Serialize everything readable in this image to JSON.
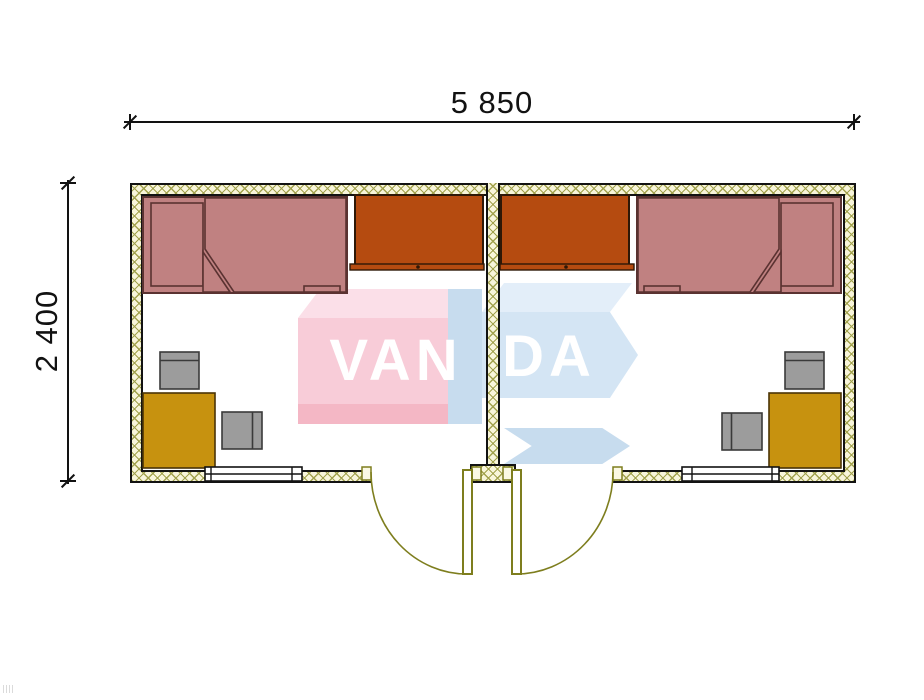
{
  "dimensions": {
    "width_label": "5 850",
    "height_label": "2 400"
  },
  "watermark": {
    "left_text": "VAN",
    "right_text": "DA"
  },
  "plan": {
    "rooms_count": 2,
    "room_contents": [
      "bed",
      "wardrobe",
      "desk",
      "chair",
      "chair",
      "window",
      "door"
    ]
  },
  "colors": {
    "line": "#121212",
    "wall_hatch_bg": "#f8f5da",
    "wall_hatch_line": "#a2a24e",
    "bed_fill": "#c08181",
    "bed_outline": "#5a3231",
    "wardrobe_fill": "#b54b10",
    "wardrobe_outline": "#2e1807",
    "desk_fill": "#c7920f",
    "desk_outline": "#4a3406",
    "chair_fill": "#9c9c9c",
    "chair_outline": "#3a3a3a",
    "door": "#7e7e1e",
    "wm_pink": "#f8ccd8",
    "wm_pink_top": "#fbdfe8",
    "wm_pink_dark": "#f4b7c5",
    "wm_blue": "#d4e5f4",
    "wm_blue_top": "#e3eef9",
    "wm_blue_side": "#c7dcee",
    "wm_letter": "#ffffff"
  }
}
